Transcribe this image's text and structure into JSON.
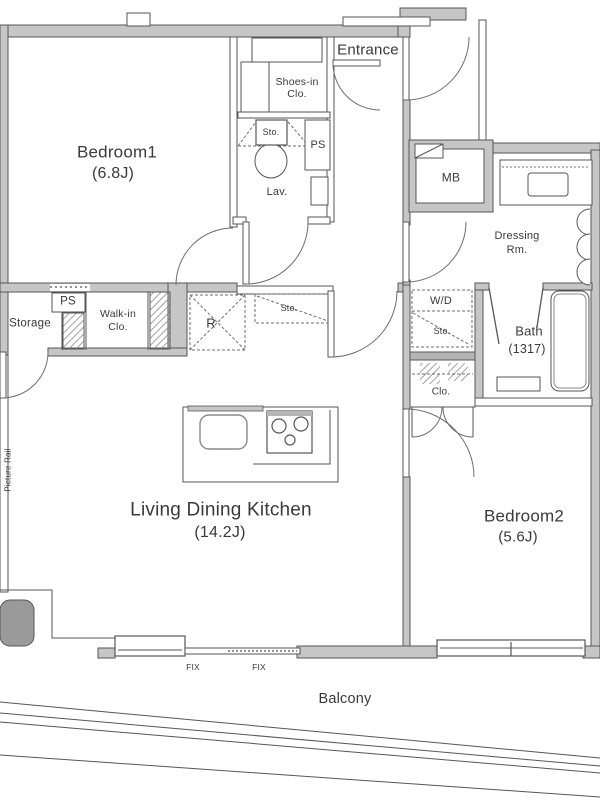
{
  "colors": {
    "wall_fill": "#c6c6c6",
    "line": "#565656",
    "dash": "#6e6e6e",
    "text": "#3a3a3a",
    "column_fill": "#9a9a9a",
    "background": "#ffffff"
  },
  "rooms": {
    "bedroom1": {
      "label": "Bedroom1",
      "size": "(6.8J)"
    },
    "bedroom2": {
      "label": "Bedroom2",
      "size": "(5.6J)"
    },
    "ldk": {
      "label": "Living Dining Kitchen",
      "size": "(14.2J)"
    },
    "bath": {
      "label": "Bath",
      "size": "(1317)"
    },
    "dressing_room": {
      "line1": "Dressing",
      "line2": "Rm."
    },
    "entrance": {
      "label": "Entrance"
    },
    "balcony": {
      "label": "Balcony"
    },
    "storage": {
      "label": "Storage"
    },
    "walk_in_closet": {
      "line1": "Walk-in",
      "line2": "Clo."
    },
    "shoes_in_closet": {
      "line1": "Shoes-in",
      "line2": "Clo."
    },
    "lavatory": {
      "label": "Lav."
    }
  },
  "fixtures": {
    "meter_box": "MB",
    "washer_dryer": "W/D",
    "refrigerator": "R",
    "bedroom2_closet": "Clo.",
    "pipe_shaft_hall": "PS",
    "pipe_shaft_lav": "PS",
    "storage_above_lav": "Sto.",
    "storage_above_kitchen": "Sto.",
    "storage_above_wd": "Sto.",
    "fix_window_1": "FIX",
    "fix_window_2": "FIX",
    "picture_rail": "Picture Rail"
  }
}
